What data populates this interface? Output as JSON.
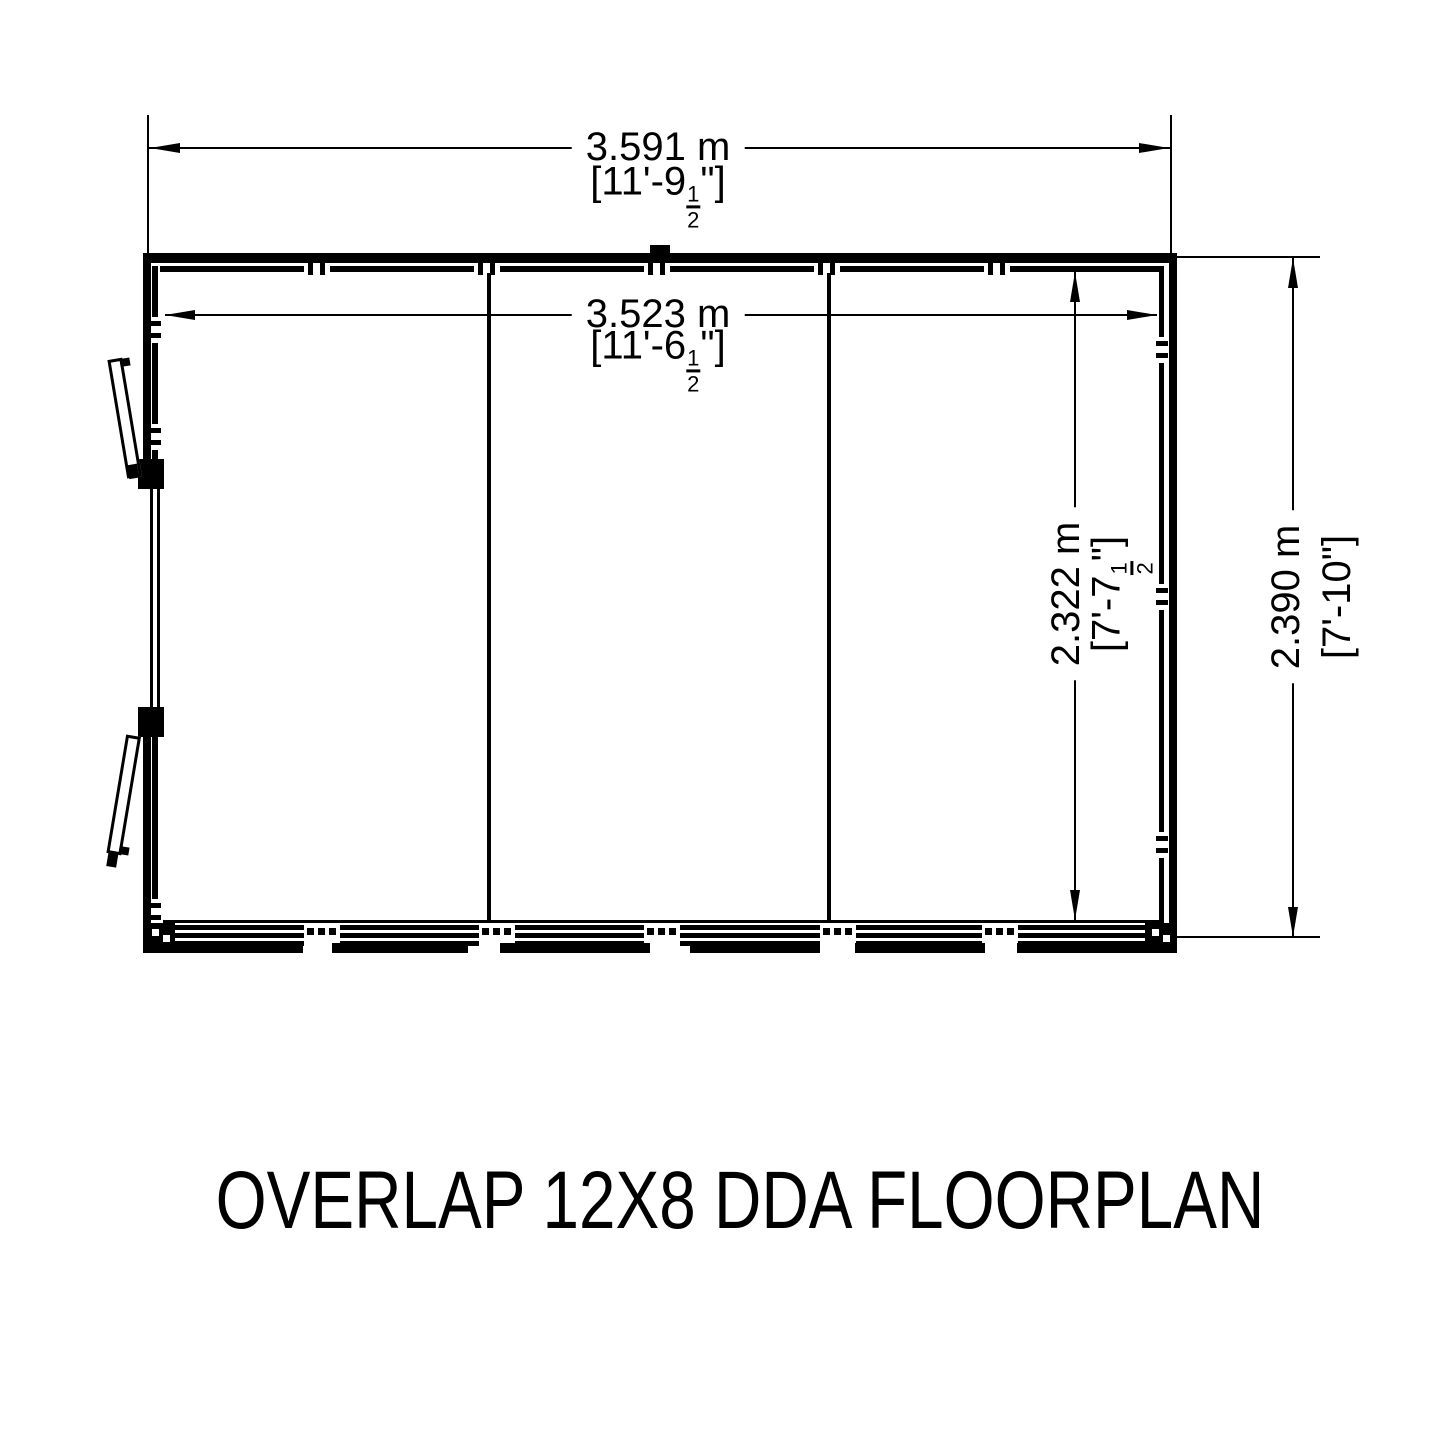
{
  "title": "OVERLAP 12X8 DDA FLOORPLAN",
  "dims": {
    "outer_width": {
      "metric": "3.591 m",
      "imp_pre": "[11'-9",
      "num": "1",
      "den": "2",
      "imp_post": "\"]"
    },
    "inner_width": {
      "metric": "3.523 m",
      "imp_pre": "[11'-6",
      "num": "1",
      "den": "2",
      "imp_post": "\"]"
    },
    "inner_depth": {
      "metric": "2.322 m",
      "imp_pre": "[7'-7",
      "num": "1",
      "den": "2",
      "imp_post": "\"]"
    },
    "outer_depth": {
      "metric": "2.390 m",
      "imp_pre": "[7'-10",
      "num": "",
      "den": "",
      "imp_post": "\"]"
    }
  },
  "colors": {
    "line": "#000000",
    "background": "#ffffff"
  }
}
